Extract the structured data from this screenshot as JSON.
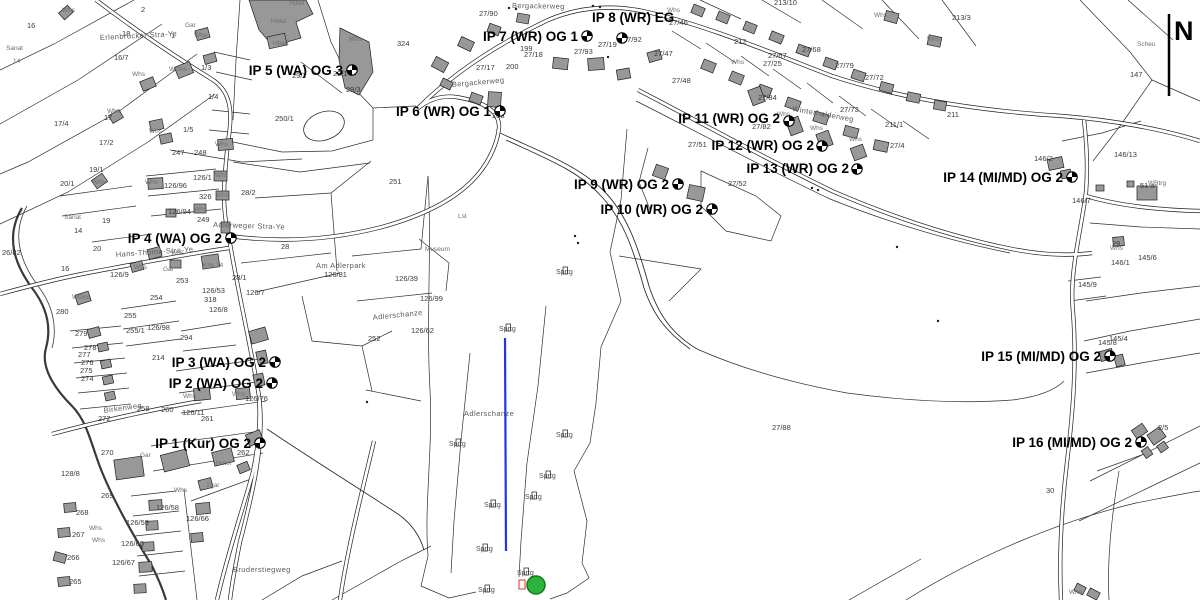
{
  "map": {
    "north": {
      "label": "N"
    },
    "colors": {
      "background": "#ffffff",
      "building_fill": "#989898",
      "line": "#1f1f1f",
      "jump_line_blue": "#2233ee",
      "landing_circle_green": "#2eb23c",
      "landing_circle_stroke": "#0c7a1e",
      "red_marker": "#e03030"
    },
    "ips": [
      {
        "label": "IP 1 (Kur) OG 2",
        "lx": 251,
        "ly": 448,
        "anchor": "end",
        "mx": 260,
        "my": 443
      },
      {
        "label": "IP 2 (WA) OG 2",
        "lx": 263,
        "ly": 388,
        "anchor": "end",
        "mx": 272,
        "my": 383
      },
      {
        "label": "IP 3 (WA) OG 2",
        "lx": 266,
        "ly": 367,
        "anchor": "end",
        "mx": 275,
        "my": 362
      },
      {
        "label": "IP 4 (WA) OG 2",
        "lx": 222,
        "ly": 243,
        "anchor": "end",
        "mx": 231,
        "my": 238
      },
      {
        "label": "IP 5 (WA) OG 3",
        "lx": 343,
        "ly": 75,
        "anchor": "end",
        "mx": 352,
        "my": 70
      },
      {
        "label": "IP 6 (WR) OG 1",
        "lx": 491,
        "ly": 116,
        "anchor": "end",
        "mx": 500,
        "my": 111
      },
      {
        "label": "IP 7 (WR) OG 1",
        "lx": 578,
        "ly": 41,
        "anchor": "end",
        "mx": 587,
        "my": 36
      },
      {
        "label": "IP 8 (WR) EG",
        "lx": 592,
        "ly": 22,
        "anchor": "start",
        "mx": 622,
        "my": 38
      },
      {
        "label": "IP 9 (WR) OG 2",
        "lx": 669,
        "ly": 189,
        "anchor": "end",
        "mx": 678,
        "my": 184
      },
      {
        "label": "IP 10 (WR) OG 2",
        "lx": 703,
        "ly": 214,
        "anchor": "end",
        "mx": 712,
        "my": 209
      },
      {
        "label": "IP 11 (WR) OG 2",
        "lx": 780,
        "ly": 123,
        "anchor": "end",
        "mx": 789,
        "my": 121
      },
      {
        "label": "IP 12 (WR) OG 2",
        "lx": 814,
        "ly": 150,
        "anchor": "end",
        "mx": 822,
        "my": 146
      },
      {
        "label": "IP 13 (WR) OG 2",
        "lx": 849,
        "ly": 173,
        "anchor": "end",
        "mx": 857,
        "my": 169
      },
      {
        "label": "IP 14 (MI/MD) OG 2",
        "lx": 1063,
        "ly": 182,
        "anchor": "end",
        "mx": 1072,
        "my": 177
      },
      {
        "label": "IP 15 (MI/MD) OG 2",
        "lx": 1101,
        "ly": 361,
        "anchor": "end",
        "mx": 1110,
        "my": 356
      },
      {
        "label": "IP 16 (MI/MD) OG 2",
        "lx": 1132,
        "ly": 447,
        "anchor": "end",
        "mx": 1141,
        "my": 442
      }
    ],
    "streets": [
      {
        "t": "Bergackerweg",
        "x": 512,
        "y": 8,
        "r": 1
      },
      {
        "t": "Bergackerweg",
        "x": 452,
        "y": 87,
        "r": -5
      },
      {
        "t": "Erlenbrucker Stra-Ye",
        "x": 100,
        "y": 40,
        "r": -3
      },
      {
        "t": "Adlerweger Stra-Ye",
        "x": 213,
        "y": 227,
        "r": 2
      },
      {
        "t": "Hans-Thoma-Stra-Ye",
        "x": 116,
        "y": 257,
        "r": -4
      },
      {
        "t": "Winterhalderweg",
        "x": 792,
        "y": 111,
        "r": 10
      },
      {
        "t": "Am Adlerpark",
        "x": 316,
        "y": 268,
        "r": 0
      },
      {
        "t": "Birkenweg",
        "x": 104,
        "y": 413,
        "r": -8
      },
      {
        "t": "Bruderstiegweg",
        "x": 233,
        "y": 572,
        "r": 0
      },
      {
        "t": "Adlerschanze",
        "x": 464,
        "y": 416,
        "r": 0
      },
      {
        "t": "Adlerschanze",
        "x": 373,
        "y": 320,
        "r": -6
      }
    ],
    "sprtg": {
      "label": "Sprtg",
      "pts": [
        [
          449,
          446
        ],
        [
          556,
          437
        ],
        [
          539,
          478
        ],
        [
          525,
          499
        ],
        [
          484,
          507
        ],
        [
          476,
          551
        ],
        [
          517,
          575
        ],
        [
          478,
          592
        ],
        [
          556,
          274
        ],
        [
          499,
          331
        ]
      ]
    },
    "parcel_labels": [
      {
        "t": "16",
        "x": 27,
        "y": 28
      },
      {
        "t": "2",
        "x": 141,
        "y": 12
      },
      {
        "t": "18",
        "x": 122,
        "y": 36
      },
      {
        "t": "1",
        "x": 171,
        "y": 38
      },
      {
        "t": "16/7",
        "x": 114,
        "y": 60
      },
      {
        "t": "1/3",
        "x": 201,
        "y": 70
      },
      {
        "t": "1/4",
        "x": 208,
        "y": 99
      },
      {
        "t": "1/5",
        "x": 183,
        "y": 132
      },
      {
        "t": "17",
        "x": 104,
        "y": 120
      },
      {
        "t": "17/4",
        "x": 54,
        "y": 126
      },
      {
        "t": "17/2",
        "x": 99,
        "y": 145
      },
      {
        "t": "247",
        "x": 172,
        "y": 155
      },
      {
        "t": "248",
        "x": 194,
        "y": 155
      },
      {
        "t": "250/1",
        "x": 275,
        "y": 121
      },
      {
        "t": "29/2",
        "x": 292,
        "y": 78
      },
      {
        "t": "29/1",
        "x": 333,
        "y": 76
      },
      {
        "t": "29/3",
        "x": 346,
        "y": 92
      },
      {
        "t": "324",
        "x": 397,
        "y": 46
      },
      {
        "t": "251",
        "x": 389,
        "y": 184
      },
      {
        "t": "27/90",
        "x": 479,
        "y": 16
      },
      {
        "t": "199",
        "x": 520,
        "y": 51
      },
      {
        "t": "27/18",
        "x": 524,
        "y": 57
      },
      {
        "t": "200",
        "x": 506,
        "y": 69
      },
      {
        "t": "27/17",
        "x": 476,
        "y": 70
      },
      {
        "t": "27/93",
        "x": 574,
        "y": 54
      },
      {
        "t": "27/19",
        "x": 598,
        "y": 47
      },
      {
        "t": "27/92",
        "x": 623,
        "y": 42
      },
      {
        "t": "27/46",
        "x": 669,
        "y": 25
      },
      {
        "t": "27/47",
        "x": 654,
        "y": 56
      },
      {
        "t": "27/48",
        "x": 672,
        "y": 83
      },
      {
        "t": "208",
        "x": 492,
        "y": 118
      },
      {
        "t": "213/10",
        "x": 774,
        "y": 5
      },
      {
        "t": "213/3",
        "x": 952,
        "y": 20
      },
      {
        "t": "212",
        "x": 734,
        "y": 44
      },
      {
        "t": "27/68",
        "x": 802,
        "y": 52
      },
      {
        "t": "27/67",
        "x": 768,
        "y": 58
      },
      {
        "t": "27/25",
        "x": 763,
        "y": 66
      },
      {
        "t": "27/79",
        "x": 835,
        "y": 68
      },
      {
        "t": "27/72",
        "x": 865,
        "y": 80
      },
      {
        "t": "27/84",
        "x": 758,
        "y": 100
      },
      {
        "t": "27/73",
        "x": 840,
        "y": 112
      },
      {
        "t": "211",
        "x": 947,
        "y": 117
      },
      {
        "t": "211/1",
        "x": 885,
        "y": 127
      },
      {
        "t": "27/4",
        "x": 890,
        "y": 148
      },
      {
        "t": "27/82",
        "x": 752,
        "y": 129
      },
      {
        "t": "27/51",
        "x": 688,
        "y": 147
      },
      {
        "t": "27/52",
        "x": 728,
        "y": 186
      },
      {
        "t": "27/88",
        "x": 772,
        "y": 430
      },
      {
        "t": "146/2",
        "x": 1034,
        "y": 161
      },
      {
        "t": "146/13",
        "x": 1114,
        "y": 157
      },
      {
        "t": "147",
        "x": 1130,
        "y": 77
      },
      {
        "t": "146/7",
        "x": 1072,
        "y": 203
      },
      {
        "t": "146/1",
        "x": 1111,
        "y": 265
      },
      {
        "t": "145/9",
        "x": 1078,
        "y": 287
      },
      {
        "t": "145/6",
        "x": 1138,
        "y": 260
      },
      {
        "t": "145/8",
        "x": 1098,
        "y": 345
      },
      {
        "t": "145/4",
        "x": 1109,
        "y": 341
      },
      {
        "t": "28",
        "x": 1112,
        "y": 246
      },
      {
        "t": "51 a",
        "x": 1140,
        "y": 188
      },
      {
        "t": "30",
        "x": 1046,
        "y": 493
      },
      {
        "t": "2/5",
        "x": 1158,
        "y": 430
      },
      {
        "t": "19/1",
        "x": 89,
        "y": 172
      },
      {
        "t": "20/1",
        "x": 60,
        "y": 186
      },
      {
        "t": "126/96",
        "x": 164,
        "y": 188
      },
      {
        "t": "126/1",
        "x": 193,
        "y": 180
      },
      {
        "t": "326",
        "x": 199,
        "y": 199
      },
      {
        "t": "126/94",
        "x": 168,
        "y": 214
      },
      {
        "t": "249",
        "x": 197,
        "y": 222
      },
      {
        "t": "28/2",
        "x": 241,
        "y": 195
      },
      {
        "t": "28",
        "x": 281,
        "y": 249
      },
      {
        "t": "28/1",
        "x": 232,
        "y": 280
      },
      {
        "t": "20",
        "x": 93,
        "y": 251
      },
      {
        "t": "19",
        "x": 102,
        "y": 223
      },
      {
        "t": "14",
        "x": 74,
        "y": 233
      },
      {
        "t": "126/9",
        "x": 110,
        "y": 277
      },
      {
        "t": "253",
        "x": 176,
        "y": 283
      },
      {
        "t": "254",
        "x": 150,
        "y": 300
      },
      {
        "t": "255",
        "x": 124,
        "y": 318
      },
      {
        "t": "255/1",
        "x": 126,
        "y": 333
      },
      {
        "t": "126/98",
        "x": 147,
        "y": 330
      },
      {
        "t": "294",
        "x": 180,
        "y": 340
      },
      {
        "t": "280",
        "x": 56,
        "y": 314
      },
      {
        "t": "279",
        "x": 75,
        "y": 336
      },
      {
        "t": "278",
        "x": 84,
        "y": 350
      },
      {
        "t": "277",
        "x": 78,
        "y": 357
      },
      {
        "t": "276",
        "x": 81,
        "y": 365
      },
      {
        "t": "275",
        "x": 80,
        "y": 373
      },
      {
        "t": "274",
        "x": 81,
        "y": 381
      },
      {
        "t": "272",
        "x": 98,
        "y": 421
      },
      {
        "t": "258",
        "x": 137,
        "y": 411
      },
      {
        "t": "260",
        "x": 161,
        "y": 412
      },
      {
        "t": "126/11",
        "x": 182,
        "y": 415
      },
      {
        "t": "261",
        "x": 201,
        "y": 421
      },
      {
        "t": "126/76",
        "x": 245,
        "y": 401
      },
      {
        "t": "214",
        "x": 152,
        "y": 360
      },
      {
        "t": "262",
        "x": 237,
        "y": 455
      },
      {
        "t": "126/81",
        "x": 324,
        "y": 277
      },
      {
        "t": "126/39",
        "x": 395,
        "y": 281
      },
      {
        "t": "126/99",
        "x": 420,
        "y": 301
      },
      {
        "t": "126/62",
        "x": 411,
        "y": 333
      },
      {
        "t": "252",
        "x": 368,
        "y": 341
      },
      {
        "t": "26/82",
        "x": 2,
        "y": 255
      },
      {
        "t": "269",
        "x": 101,
        "y": 498
      },
      {
        "t": "270",
        "x": 101,
        "y": 455
      },
      {
        "t": "268",
        "x": 76,
        "y": 515
      },
      {
        "t": "267",
        "x": 72,
        "y": 537
      },
      {
        "t": "266",
        "x": 67,
        "y": 560
      },
      {
        "t": "265",
        "x": 69,
        "y": 584
      },
      {
        "t": "126/58",
        "x": 156,
        "y": 510
      },
      {
        "t": "126/59",
        "x": 126,
        "y": 525
      },
      {
        "t": "126/60",
        "x": 121,
        "y": 546
      },
      {
        "t": "126/67",
        "x": 112,
        "y": 565
      },
      {
        "t": "126/66",
        "x": 186,
        "y": 521
      },
      {
        "t": "128/8",
        "x": 61,
        "y": 476
      },
      {
        "t": "126/53",
        "x": 202,
        "y": 293
      },
      {
        "t": "318",
        "x": 204,
        "y": 302
      },
      {
        "t": "126/7",
        "x": 246,
        "y": 295
      },
      {
        "t": "126/8",
        "x": 209,
        "y": 312
      },
      {
        "t": "16",
        "x": 61,
        "y": 271
      }
    ],
    "building_labels": [
      {
        "t": "Hotel",
        "x": 289,
        "y": 5
      },
      {
        "t": "Hotel",
        "x": 271,
        "y": 23
      },
      {
        "t": "Hbad",
        "x": 273,
        "y": 45
      },
      {
        "t": "Whs",
        "x": 194,
        "y": 37
      },
      {
        "t": "Whs",
        "x": 349,
        "y": 41
      },
      {
        "t": "Whs",
        "x": 62,
        "y": 12
      },
      {
        "t": "Gar",
        "x": 185,
        "y": 27
      },
      {
        "t": "WGhs",
        "x": 169,
        "y": 71
      },
      {
        "t": "Whs",
        "x": 132,
        "y": 76
      },
      {
        "t": "Whs",
        "x": 107,
        "y": 113
      },
      {
        "t": "Whs",
        "x": 149,
        "y": 133
      },
      {
        "t": "Whs",
        "x": 215,
        "y": 146
      },
      {
        "t": "Sanat",
        "x": 6,
        "y": 50
      },
      {
        "t": "14",
        "x": 13,
        "y": 63
      },
      {
        "t": "Sanat",
        "x": 64,
        "y": 219
      },
      {
        "t": "Whs",
        "x": 145,
        "y": 184
      },
      {
        "t": "Whs",
        "x": 92,
        "y": 184
      },
      {
        "t": "Whs",
        "x": 215,
        "y": 177
      },
      {
        "t": "Whs",
        "x": 216,
        "y": 197
      },
      {
        "t": "Whs",
        "x": 194,
        "y": 211
      },
      {
        "t": "Whs",
        "x": 171,
        "y": 255
      },
      {
        "t": "Gar",
        "x": 163,
        "y": 271
      },
      {
        "t": "Whs",
        "x": 134,
        "y": 269
      },
      {
        "t": "Khs 14",
        "x": 203,
        "y": 267
      },
      {
        "t": "WGhs",
        "x": 72,
        "y": 299
      },
      {
        "t": "Whs",
        "x": 183,
        "y": 398
      },
      {
        "t": "Whs",
        "x": 232,
        "y": 396
      },
      {
        "t": "Hotel",
        "x": 216,
        "y": 465
      },
      {
        "t": "Tgar",
        "x": 206,
        "y": 487
      },
      {
        "t": "Gar",
        "x": 140,
        "y": 457
      },
      {
        "t": "Whs",
        "x": 174,
        "y": 492
      },
      {
        "t": "Whs",
        "x": 89,
        "y": 530
      },
      {
        "t": "Whs",
        "x": 92,
        "y": 542
      },
      {
        "t": "Museum",
        "x": 425,
        "y": 251
      },
      {
        "t": "Lst",
        "x": 458,
        "y": 218
      },
      {
        "t": "Whs",
        "x": 777,
        "y": 116
      },
      {
        "t": "Whs",
        "x": 810,
        "y": 130
      },
      {
        "t": "Whs",
        "x": 849,
        "y": 141
      },
      {
        "t": "Whs",
        "x": 874,
        "y": 17
      },
      {
        "t": "Whs",
        "x": 927,
        "y": 41
      },
      {
        "t": "Whs",
        "x": 667,
        "y": 12
      },
      {
        "t": "Whs",
        "x": 731,
        "y": 64
      },
      {
        "t": "WBtrg",
        "x": 1148,
        "y": 185
      },
      {
        "t": "Whs",
        "x": 1110,
        "y": 250
      },
      {
        "t": "Scheu",
        "x": 1137,
        "y": 46
      },
      {
        "t": "Whs",
        "x": 1069,
        "y": 594
      }
    ],
    "dots": [
      [
        593,
        6
      ],
      [
        600,
        7
      ],
      [
        509,
        8
      ],
      [
        516,
        9
      ],
      [
        575,
        236
      ],
      [
        578,
        243
      ],
      [
        812,
        188
      ],
      [
        818,
        190
      ],
      [
        938,
        321
      ],
      [
        897,
        247
      ],
      [
        367,
        402
      ],
      [
        608,
        57
      ]
    ]
  }
}
